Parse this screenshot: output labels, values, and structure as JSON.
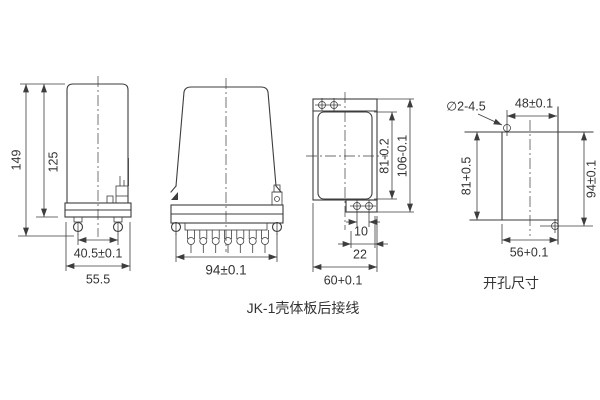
{
  "drawing": {
    "caption": "JK-1壳体板后接线",
    "colors": {
      "line": "#3d3d3d",
      "text": "#333333",
      "background": "#ffffff"
    },
    "views": {
      "side": {
        "dims": {
          "overall_height": "149",
          "case_height": "125",
          "stud_spacing": "40.5±0.1",
          "base_width": "55.5"
        }
      },
      "front": {
        "dims": {
          "mount_stud_spacing": "94±0.1"
        }
      },
      "plan": {
        "dims": {
          "case_depth": "81-0.2",
          "overall_depth": "106-0.1",
          "hole_pitch": "10",
          "hole_offset": "22",
          "overall_width": "60+0.1"
        }
      },
      "cutout": {
        "label": "开孔尺寸",
        "dims": {
          "mount_holes": "∅2-4.5",
          "hole_x_spacing": "48±0.1",
          "cutout_height": "81+0.5",
          "hole_y_spacing": "94±0.1",
          "cutout_width": "56+0.1"
        }
      }
    }
  }
}
